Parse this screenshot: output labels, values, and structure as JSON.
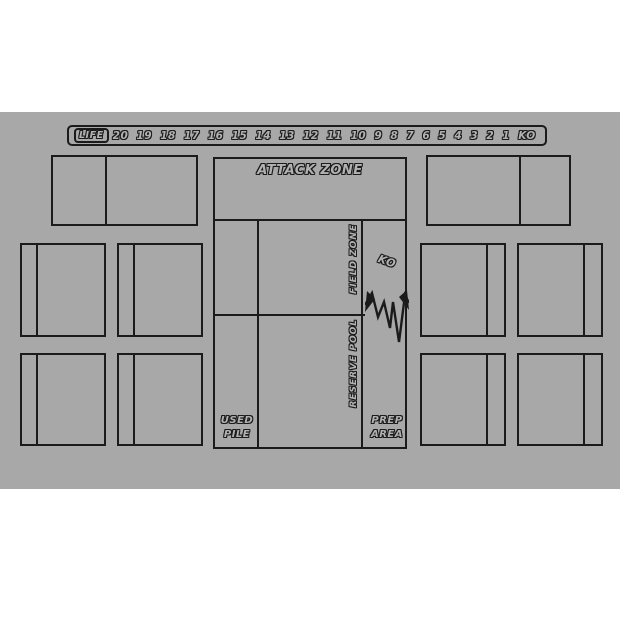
{
  "colors": {
    "page_background": "#ffffff",
    "mat_background": "#a8a8a8",
    "line": "#1b1b1b",
    "text_fill": "#b2b2b2"
  },
  "life_track": {
    "label": "LIFE",
    "values": [
      "20",
      "19",
      "18",
      "17",
      "16",
      "15",
      "14",
      "13",
      "12",
      "11",
      "10",
      "9",
      "8",
      "7",
      "6",
      "5",
      "4",
      "3",
      "2",
      "1",
      "KO"
    ]
  },
  "zones": {
    "attack_zone_label": "ATTACK ZONE",
    "field_zone_label": "FIELD ZONE",
    "reserve_pool_label": "RESERVE POOL",
    "ko_label": "KO",
    "used_pile_line1": "USED",
    "used_pile_line2": "PILE",
    "prep_area_line1": "PREP",
    "prep_area_line2": "AREA"
  }
}
